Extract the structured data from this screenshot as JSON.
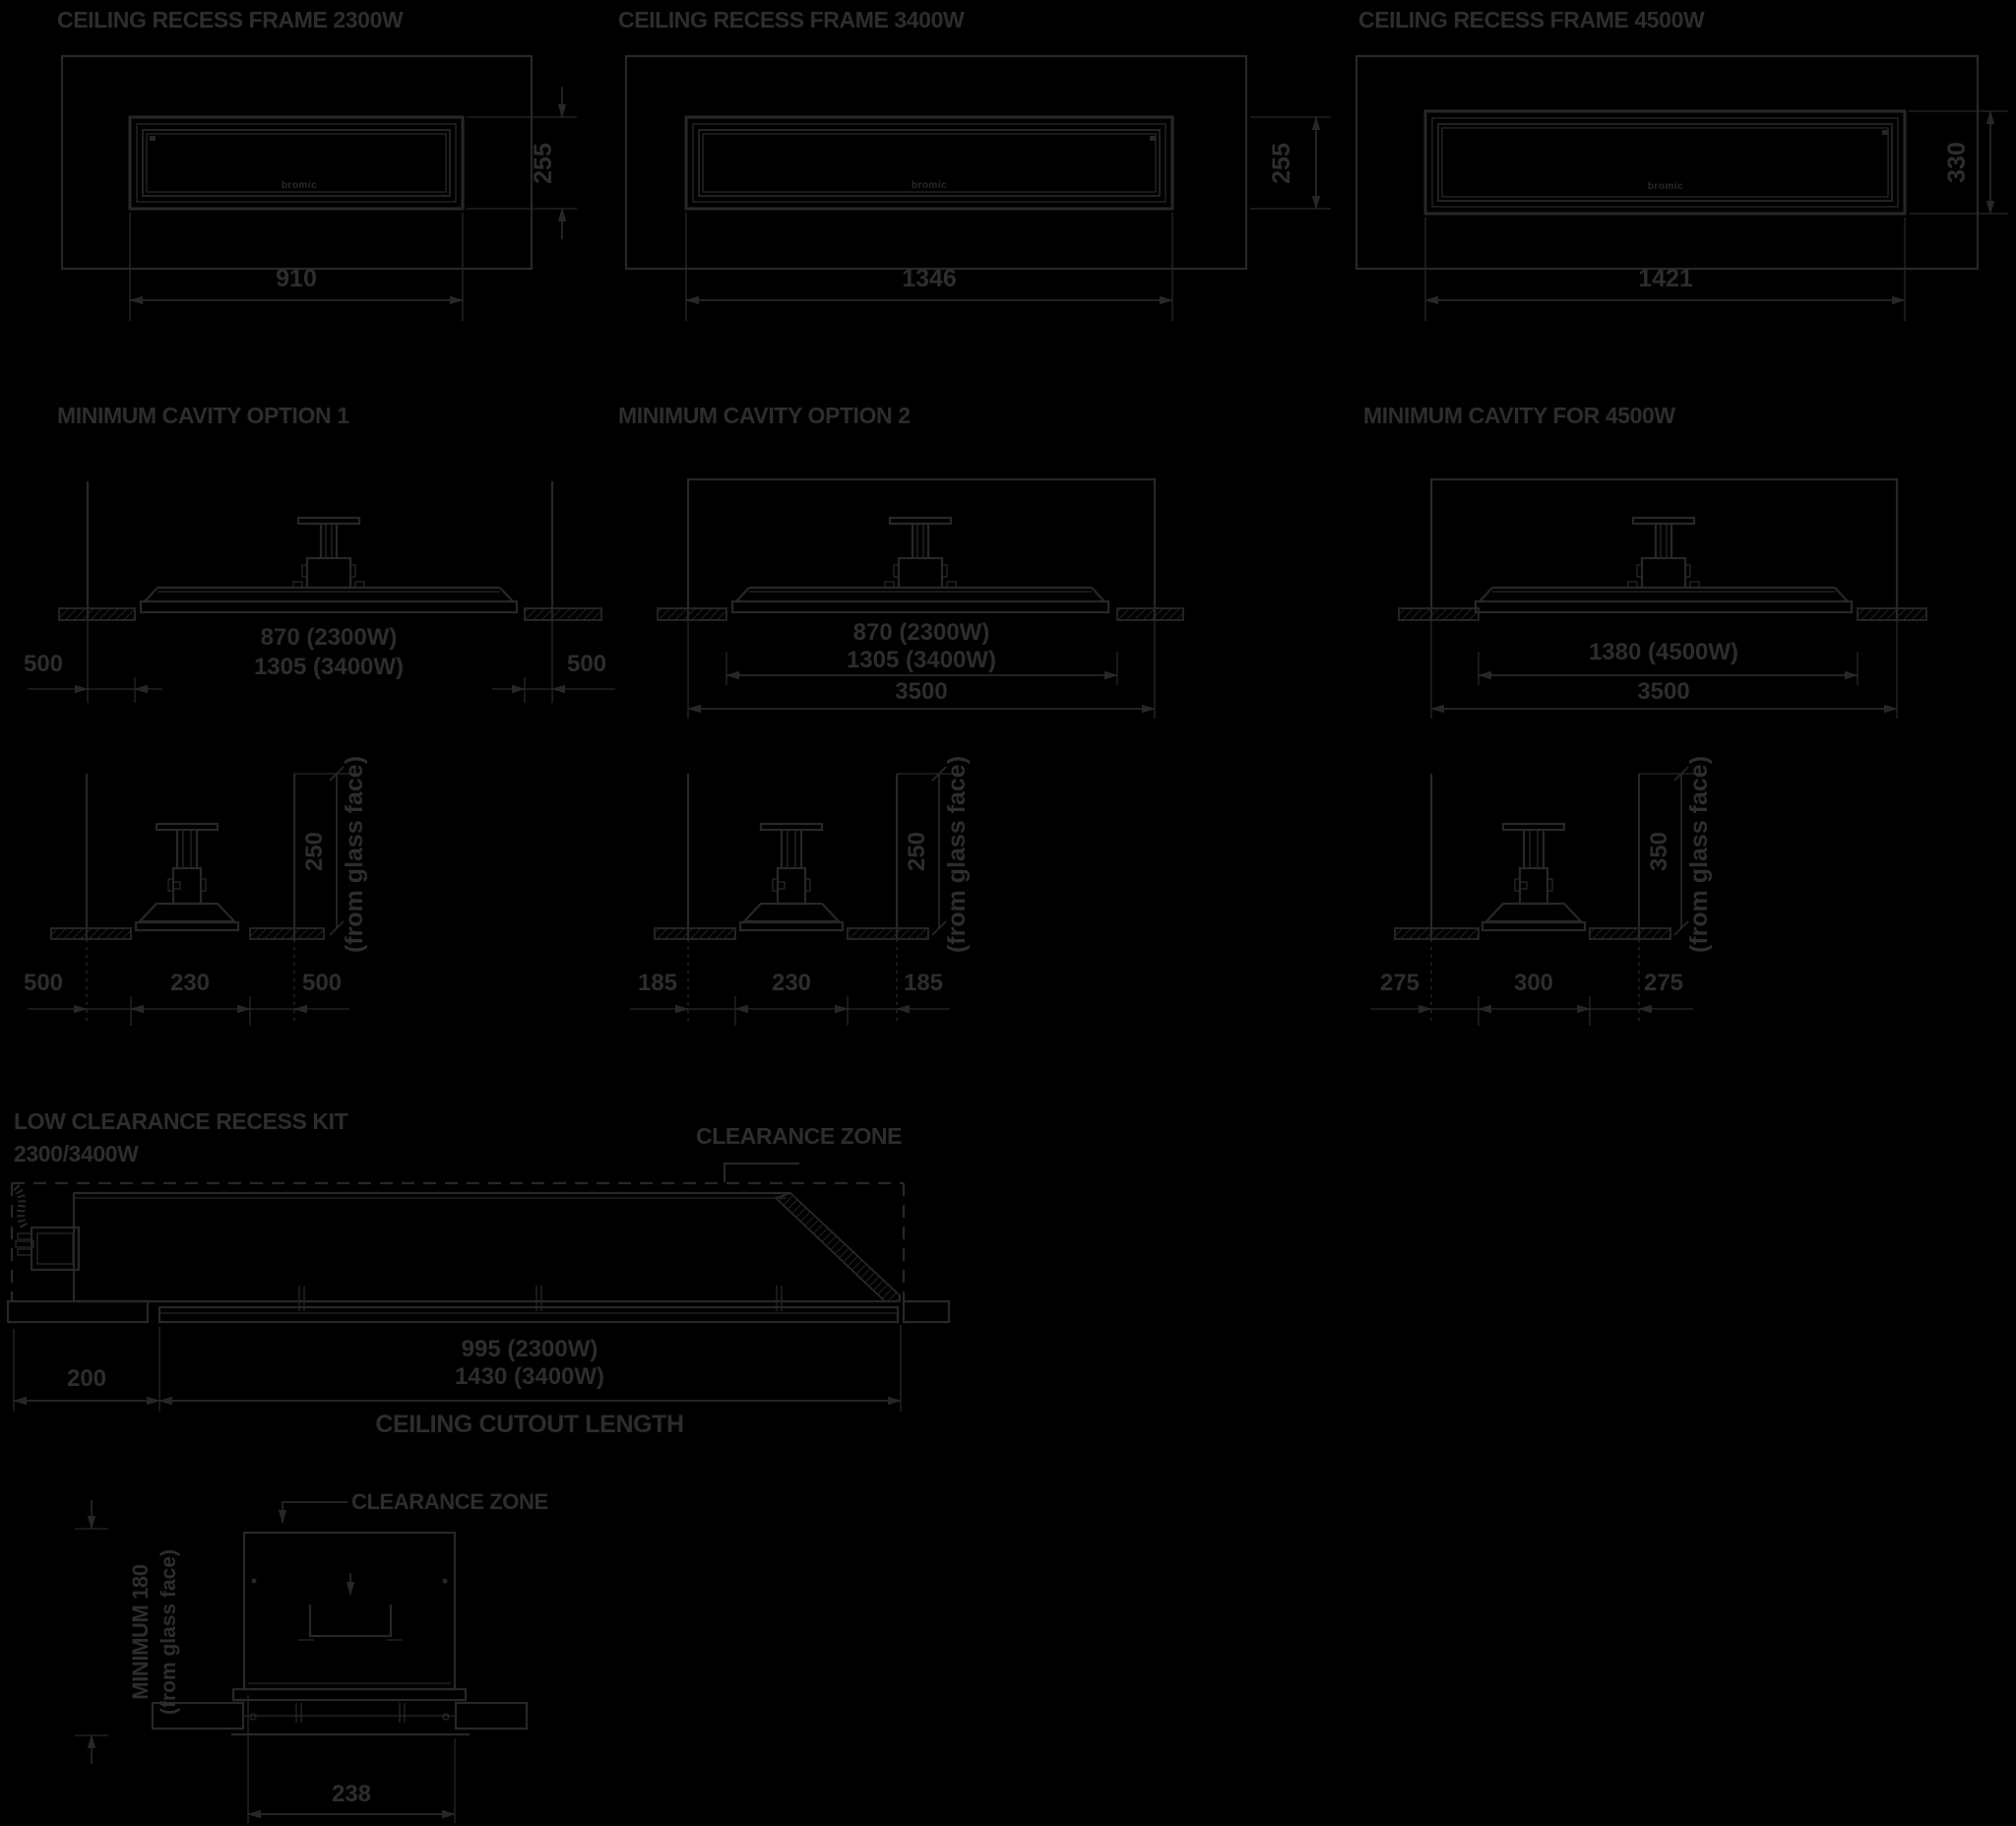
{
  "brand": "bromic",
  "frames": [
    {
      "title": "CEILING RECESS FRAME 2300W",
      "width": "910",
      "height": "255"
    },
    {
      "title": "CEILING RECESS FRAME 3400W",
      "width": "1346",
      "height": "255"
    },
    {
      "title": "CEILING RECESS FRAME 4500W",
      "width": "1421",
      "height": "330"
    }
  ],
  "cavities": [
    {
      "title": "MINIMUM CAVITY OPTION 1",
      "len_a": "870 (2300W)",
      "len_b": "1305 (3400W)",
      "left": "500",
      "right": "500"
    },
    {
      "title": "MINIMUM CAVITY OPTION 2",
      "len_a": "870 (2300W)",
      "len_b": "1305 (3400W)",
      "cavity": "3500"
    },
    {
      "title": "MINIMUM CAVITY FOR 4500W",
      "len_a": "1380 (4500W)",
      "cavity": "3500"
    }
  ],
  "end_views": [
    {
      "left": "500",
      "middle": "230",
      "right": "500",
      "depth": "250",
      "note": "(from glass face)"
    },
    {
      "left": "185",
      "middle": "230",
      "right": "185",
      "depth": "250",
      "note": "(from glass face)"
    },
    {
      "left": "275",
      "middle": "300",
      "right": "275",
      "depth": "350",
      "note": "(from glass face)"
    }
  ],
  "low_clearance": {
    "title1": "LOW CLEARANCE RECESS KIT",
    "title2": "2300/3400W",
    "clearance_zone": "CLEARANCE ZONE",
    "offset": "200",
    "len_a": "995 (2300W)",
    "len_b": "1430 (3400W)",
    "cutout_label": "CEILING CUTOUT LENGTH"
  },
  "cross_section": {
    "clearance_zone": "CLEARANCE ZONE",
    "min_label": "MINIMUM  180",
    "note": "(from glass face)",
    "width": "238"
  }
}
